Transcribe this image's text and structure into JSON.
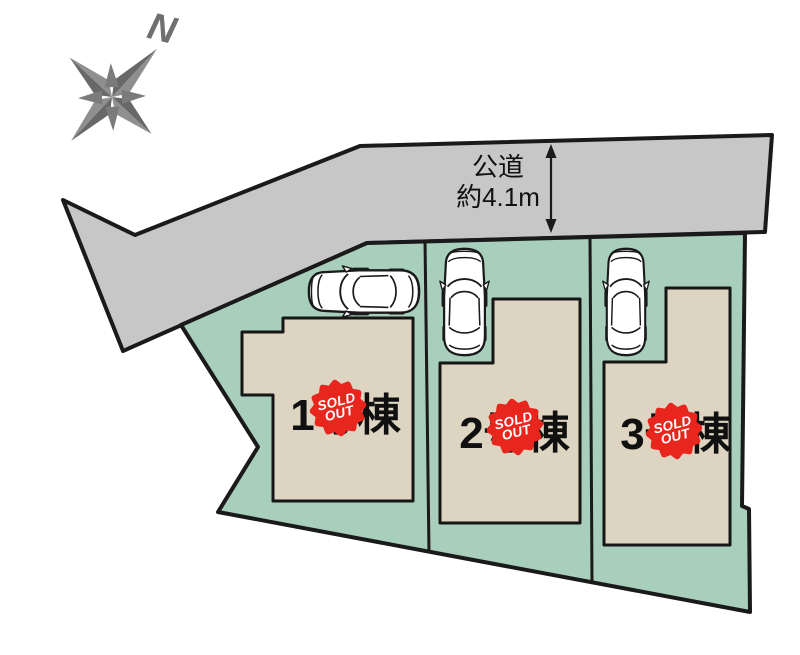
{
  "diagram": {
    "compass": {
      "north_label": "N"
    },
    "road": {
      "line1": "公道",
      "line2": "約4.1m"
    },
    "lots": [
      {
        "name": "1号棟",
        "status": "SOLD OUT"
      },
      {
        "name": "2号棟",
        "status": "SOLD OUT"
      },
      {
        "name": "3号棟",
        "status": "SOLD OUT"
      }
    ],
    "badge": {
      "line1": "SOLD",
      "line2": "OUT",
      "full": "SOLD OUT"
    },
    "icons": {
      "compass": "compass-rose-icon",
      "car": "car-top-view-icon",
      "dimension": "vertical-double-arrow-icon"
    },
    "colors": {
      "road_gray": "#c7c7c7",
      "plot_green": "#a8cebc",
      "house_beige": "#ddd5c1",
      "badge_red": "#e8261e",
      "outline_black": "#1a1a1a",
      "compass_gray": "#6f6f6f"
    }
  }
}
